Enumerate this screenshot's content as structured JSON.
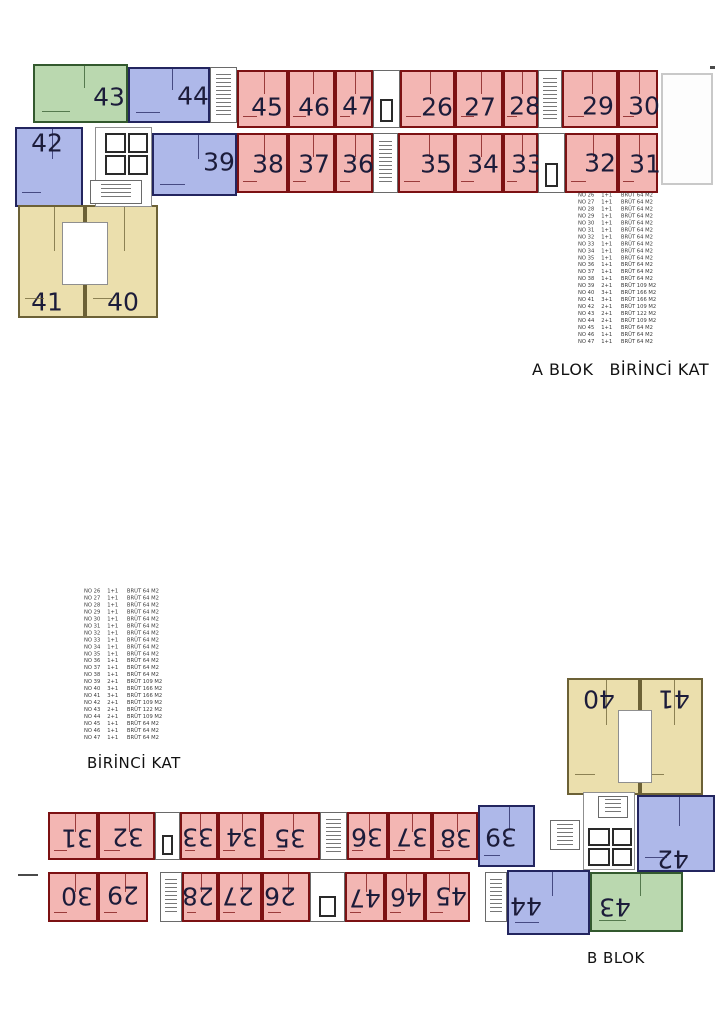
{
  "labels": {
    "a_block": "A BLOK",
    "a_floor": "BİRİNCİ KAT",
    "left_floor": "BİRİNCİ KAT",
    "b_block": "B BLOK"
  },
  "colors": {
    "red_fill": "#f3b6b3",
    "red_wall": "#7c1113",
    "blue_fill": "#aeb8e9",
    "blue_wall": "#23255f",
    "green_fill": "#bad8af",
    "green_wall": "#33592e",
    "yellow_fill": "#ebdfad",
    "yellow_wall": "#6c6136",
    "number": "#1c1c3a"
  },
  "legend": {
    "rows": [
      {
        "no": "NO 26",
        "type": "1+1",
        "size": "BRÜT 64 M2"
      },
      {
        "no": "NO 27",
        "type": "1+1",
        "size": "BRÜT 64 M2"
      },
      {
        "no": "NO 28",
        "type": "1+1",
        "size": "BRÜT 64 M2"
      },
      {
        "no": "NO 29",
        "type": "1+1",
        "size": "BRÜT 64 M2"
      },
      {
        "no": "NO 30",
        "type": "1+1",
        "size": "BRÜT 64 M2"
      },
      {
        "no": "NO 31",
        "type": "1+1",
        "size": "BRÜT 64 M2"
      },
      {
        "no": "NO 32",
        "type": "1+1",
        "size": "BRÜT 64 M2"
      },
      {
        "no": "NO 33",
        "type": "1+1",
        "size": "BRÜT 64 M2"
      },
      {
        "no": "NO 34",
        "type": "1+1",
        "size": "BRÜT 64 M2"
      },
      {
        "no": "NO 35",
        "type": "1+1",
        "size": "BRÜT 64 M2"
      },
      {
        "no": "NO 36",
        "type": "1+1",
        "size": "BRÜT 64 M2"
      },
      {
        "no": "NO 37",
        "type": "1+1",
        "size": "BRÜT 64 M2"
      },
      {
        "no": "NO 38",
        "type": "1+1",
        "size": "BRÜT 64 M2"
      },
      {
        "no": "NO 39",
        "type": "2+1",
        "size": "BRÜT 109 M2"
      },
      {
        "no": "NO 40",
        "type": "3+1",
        "size": "BRÜT 166 M2"
      },
      {
        "no": "NO 41",
        "type": "3+1",
        "size": "BRÜT 166 M2"
      },
      {
        "no": "NO 42",
        "type": "2+1",
        "size": "BRÜT 109 M2"
      },
      {
        "no": "NO 43",
        "type": "2+1",
        "size": "BRÜT 122 M2"
      },
      {
        "no": "NO 44",
        "type": "2+1",
        "size": "BRÜT 109 M2"
      },
      {
        "no": "NO 45",
        "type": "1+1",
        "size": "BRÜT 64 M2"
      },
      {
        "no": "NO 46",
        "type": "1+1",
        "size": "BRÜT 64 M2"
      },
      {
        "no": "NO 47",
        "type": "1+1",
        "size": "BRÜT 64 M2"
      }
    ]
  },
  "plans": {
    "a": {
      "rotated": false,
      "units": [
        {
          "n": "43",
          "c": "green",
          "x": 33,
          "y": 64,
          "w": 95,
          "h": 59,
          "lx": 107,
          "ly": 95
        },
        {
          "n": "44",
          "c": "blue",
          "x": 128,
          "y": 67,
          "w": 82,
          "h": 56,
          "lx": 191,
          "ly": 94
        },
        {
          "n": "45",
          "c": "red",
          "x": 237,
          "y": 70,
          "w": 51,
          "h": 58,
          "lx": 265,
          "ly": 105
        },
        {
          "n": "46",
          "c": "red",
          "x": 288,
          "y": 70,
          "w": 47,
          "h": 58,
          "lx": 312,
          "ly": 105
        },
        {
          "n": "47",
          "c": "red",
          "x": 335,
          "y": 70,
          "w": 38,
          "h": 58,
          "lx": 356,
          "ly": 104
        },
        {
          "n": "26",
          "c": "red",
          "x": 400,
          "y": 70,
          "w": 55,
          "h": 58,
          "lx": 435,
          "ly": 105
        },
        {
          "n": "27",
          "c": "red",
          "x": 455,
          "y": 70,
          "w": 48,
          "h": 58,
          "lx": 478,
          "ly": 105
        },
        {
          "n": "28",
          "c": "red",
          "x": 503,
          "y": 70,
          "w": 35,
          "h": 58,
          "lx": 523,
          "ly": 104
        },
        {
          "n": "29",
          "c": "red",
          "x": 562,
          "y": 70,
          "w": 56,
          "h": 58,
          "lx": 596,
          "ly": 104
        },
        {
          "n": "30",
          "c": "red",
          "x": 618,
          "y": 70,
          "w": 40,
          "h": 58,
          "lx": 642,
          "ly": 104
        },
        {
          "n": "42",
          "c": "blue",
          "x": 15,
          "y": 127,
          "w": 68,
          "h": 80,
          "lx": 45,
          "ly": 141
        },
        {
          "n": "39",
          "c": "blue",
          "x": 152,
          "y": 133,
          "w": 85,
          "h": 63,
          "lx": 217,
          "ly": 160
        },
        {
          "n": "38",
          "c": "red",
          "x": 237,
          "y": 133,
          "w": 51,
          "h": 60,
          "lx": 266,
          "ly": 162
        },
        {
          "n": "37",
          "c": "red",
          "x": 288,
          "y": 133,
          "w": 47,
          "h": 60,
          "lx": 312,
          "ly": 162
        },
        {
          "n": "36",
          "c": "red",
          "x": 335,
          "y": 133,
          "w": 38,
          "h": 60,
          "lx": 356,
          "ly": 162
        },
        {
          "n": "35",
          "c": "red",
          "x": 398,
          "y": 133,
          "w": 57,
          "h": 60,
          "lx": 434,
          "ly": 162
        },
        {
          "n": "34",
          "c": "red",
          "x": 455,
          "y": 133,
          "w": 48,
          "h": 60,
          "lx": 481,
          "ly": 162
        },
        {
          "n": "33",
          "c": "red",
          "x": 503,
          "y": 133,
          "w": 35,
          "h": 60,
          "lx": 525,
          "ly": 162
        },
        {
          "n": "32",
          "c": "red",
          "x": 565,
          "y": 133,
          "w": 53,
          "h": 60,
          "lx": 598,
          "ly": 161
        },
        {
          "n": "31",
          "c": "red",
          "x": 618,
          "y": 133,
          "w": 40,
          "h": 60,
          "lx": 643,
          "ly": 162
        },
        {
          "n": "41",
          "c": "yellow",
          "x": 18,
          "y": 205,
          "w": 67,
          "h": 113,
          "lx": 45,
          "ly": 300
        },
        {
          "n": "40",
          "c": "yellow",
          "x": 85,
          "y": 205,
          "w": 73,
          "h": 113,
          "lx": 121,
          "ly": 300
        }
      ],
      "cores": [
        {
          "k": "stair",
          "x": 210,
          "y": 67,
          "w": 27,
          "h": 56
        },
        {
          "k": "elev2",
          "x": 373,
          "y": 70,
          "w": 27,
          "h": 58
        },
        {
          "k": "stair",
          "x": 538,
          "y": 70,
          "w": 24,
          "h": 58
        },
        {
          "k": "stair",
          "x": 373,
          "y": 133,
          "w": 25,
          "h": 60
        },
        {
          "k": "elev2",
          "x": 538,
          "y": 133,
          "w": 27,
          "h": 60
        },
        {
          "k": "room",
          "x": 95,
          "y": 127,
          "w": 57,
          "h": 80
        },
        {
          "k": "shaft",
          "x": 105,
          "y": 133,
          "w": 21,
          "h": 20
        },
        {
          "k": "shaft",
          "x": 105,
          "y": 155,
          "w": 21,
          "h": 20
        },
        {
          "k": "shaft",
          "x": 128,
          "y": 133,
          "w": 20,
          "h": 20
        },
        {
          "k": "shaft",
          "x": 128,
          "y": 155,
          "w": 20,
          "h": 20
        },
        {
          "k": "stair",
          "x": 90,
          "y": 180,
          "w": 52,
          "h": 24
        },
        {
          "k": "room",
          "x": 62,
          "y": 222,
          "w": 46,
          "h": 63
        },
        {
          "k": "terrace",
          "x": 661,
          "y": 73,
          "w": 52,
          "h": 112
        },
        {
          "k": "tick",
          "x": 710,
          "y": 66,
          "w": 5,
          "h": 3
        }
      ]
    },
    "b": {
      "rotated": true,
      "units": [
        {
          "n": "31",
          "c": "red",
          "x": 48,
          "y": 812,
          "w": 50,
          "h": 48,
          "lx": 75,
          "ly": 836
        },
        {
          "n": "32",
          "c": "red",
          "x": 98,
          "y": 812,
          "w": 57,
          "h": 48,
          "lx": 126,
          "ly": 835
        },
        {
          "n": "33",
          "c": "red",
          "x": 180,
          "y": 812,
          "w": 38,
          "h": 48,
          "lx": 196,
          "ly": 835
        },
        {
          "n": "34",
          "c": "red",
          "x": 218,
          "y": 812,
          "w": 44,
          "h": 48,
          "lx": 240,
          "ly": 835
        },
        {
          "n": "35",
          "c": "red",
          "x": 262,
          "y": 812,
          "w": 58,
          "h": 48,
          "lx": 288,
          "ly": 836
        },
        {
          "n": "36",
          "c": "red",
          "x": 347,
          "y": 812,
          "w": 41,
          "h": 48,
          "lx": 365,
          "ly": 835
        },
        {
          "n": "37",
          "c": "red",
          "x": 388,
          "y": 812,
          "w": 44,
          "h": 48,
          "lx": 410,
          "ly": 835
        },
        {
          "n": "38",
          "c": "red",
          "x": 432,
          "y": 812,
          "w": 46,
          "h": 48,
          "lx": 454,
          "ly": 836
        },
        {
          "n": "39",
          "c": "blue",
          "x": 478,
          "y": 805,
          "w": 57,
          "h": 62,
          "lx": 499,
          "ly": 835
        },
        {
          "n": "30",
          "c": "red",
          "x": 48,
          "y": 872,
          "w": 50,
          "h": 50,
          "lx": 75,
          "ly": 894
        },
        {
          "n": "29",
          "c": "red",
          "x": 98,
          "y": 872,
          "w": 50,
          "h": 50,
          "lx": 121,
          "ly": 893
        },
        {
          "n": "28",
          "c": "red",
          "x": 182,
          "y": 872,
          "w": 36,
          "h": 50,
          "lx": 196,
          "ly": 894
        },
        {
          "n": "27",
          "c": "red",
          "x": 218,
          "y": 872,
          "w": 44,
          "h": 50,
          "lx": 236,
          "ly": 894
        },
        {
          "n": "26",
          "c": "red",
          "x": 262,
          "y": 872,
          "w": 48,
          "h": 50,
          "lx": 278,
          "ly": 894
        },
        {
          "n": "47",
          "c": "red",
          "x": 345,
          "y": 872,
          "w": 40,
          "h": 50,
          "lx": 363,
          "ly": 896
        },
        {
          "n": "46",
          "c": "red",
          "x": 385,
          "y": 872,
          "w": 40,
          "h": 50,
          "lx": 404,
          "ly": 895
        },
        {
          "n": "45",
          "c": "red",
          "x": 425,
          "y": 872,
          "w": 45,
          "h": 50,
          "lx": 449,
          "ly": 894
        },
        {
          "n": "44",
          "c": "blue",
          "x": 507,
          "y": 870,
          "w": 83,
          "h": 65,
          "lx": 524,
          "ly": 904
        },
        {
          "n": "43",
          "c": "green",
          "x": 590,
          "y": 872,
          "w": 93,
          "h": 60,
          "lx": 613,
          "ly": 905
        },
        {
          "n": "42",
          "c": "blue",
          "x": 637,
          "y": 795,
          "w": 78,
          "h": 77,
          "lx": 671,
          "ly": 857
        },
        {
          "n": "40",
          "c": "yellow",
          "x": 567,
          "y": 678,
          "w": 73,
          "h": 117,
          "lx": 597,
          "ly": 697
        },
        {
          "n": "41",
          "c": "yellow",
          "x": 640,
          "y": 678,
          "w": 63,
          "h": 117,
          "lx": 672,
          "ly": 697
        }
      ],
      "cores": [
        {
          "k": "elev2",
          "x": 155,
          "y": 812,
          "w": 25,
          "h": 48
        },
        {
          "k": "stair",
          "x": 320,
          "y": 812,
          "w": 27,
          "h": 48
        },
        {
          "k": "stair",
          "x": 160,
          "y": 872,
          "w": 22,
          "h": 50
        },
        {
          "k": "elev2",
          "x": 310,
          "y": 872,
          "w": 35,
          "h": 50
        },
        {
          "k": "stair",
          "x": 485,
          "y": 872,
          "w": 22,
          "h": 50
        },
        {
          "k": "room",
          "x": 583,
          "y": 792,
          "w": 52,
          "h": 78
        },
        {
          "k": "shaft",
          "x": 588,
          "y": 828,
          "w": 22,
          "h": 18
        },
        {
          "k": "shaft",
          "x": 588,
          "y": 848,
          "w": 22,
          "h": 18
        },
        {
          "k": "shaft",
          "x": 612,
          "y": 828,
          "w": 20,
          "h": 18
        },
        {
          "k": "shaft",
          "x": 612,
          "y": 848,
          "w": 20,
          "h": 18
        },
        {
          "k": "stair",
          "x": 598,
          "y": 796,
          "w": 30,
          "h": 22
        },
        {
          "k": "stair",
          "x": 550,
          "y": 820,
          "w": 30,
          "h": 30
        },
        {
          "k": "room",
          "x": 618,
          "y": 710,
          "w": 34,
          "h": 73
        },
        {
          "k": "tick",
          "x": 18,
          "y": 874,
          "w": 20,
          "h": 2
        }
      ]
    }
  }
}
